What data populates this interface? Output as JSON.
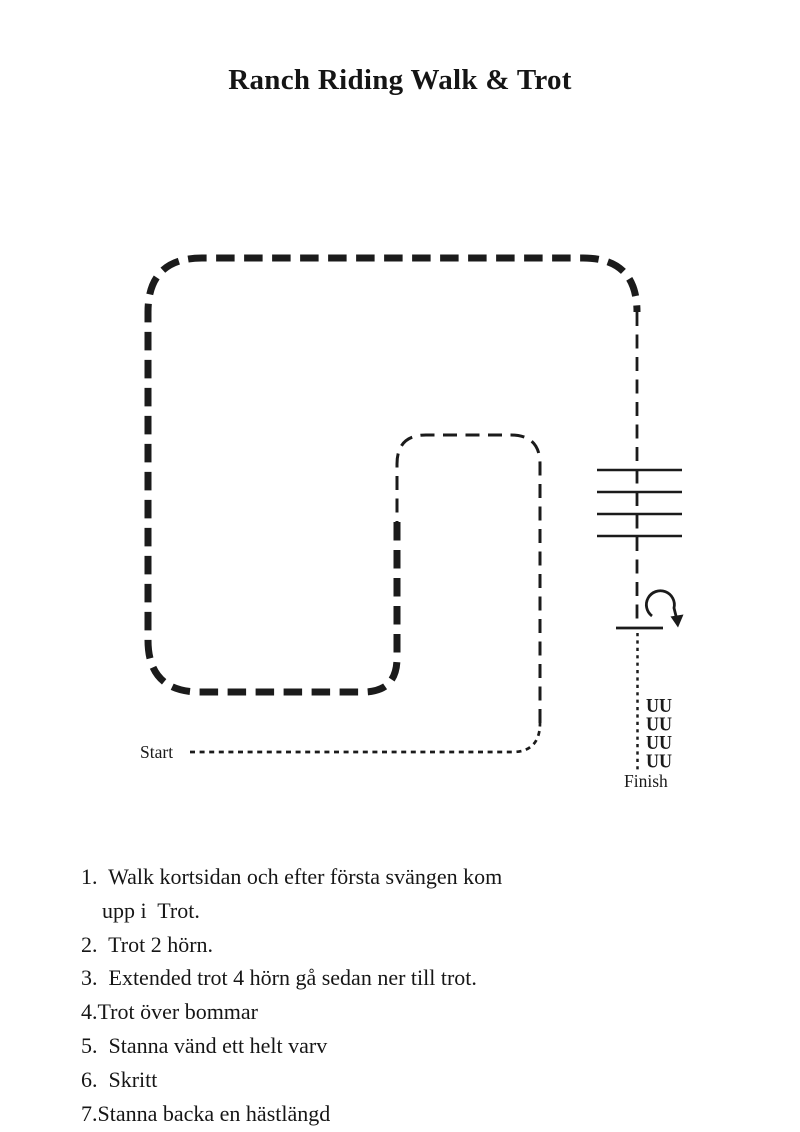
{
  "colors": {
    "ink": "#1b1b1b",
    "background": "#ffffff"
  },
  "title": "Ranch Riding Walk & Trot",
  "diagram": {
    "start_label": "Start",
    "finish_label": "Finish",
    "poles_count": 4,
    "backup_rows": [
      "UU",
      "UU",
      "UU",
      "UU"
    ]
  },
  "instructions": {
    "lines": [
      "1.  Walk kortsidan och efter första svängen kom",
      "upp i  Trot.",
      "2.  Trot 2 hörn.",
      "3.  Extended trot 4 hörn gå sedan ner till trot.",
      "4.Trot över bommar",
      "5.  Stanna vänd ett helt varv",
      "6.  Skritt",
      "7.Stanna backa en hästlängd"
    ]
  }
}
